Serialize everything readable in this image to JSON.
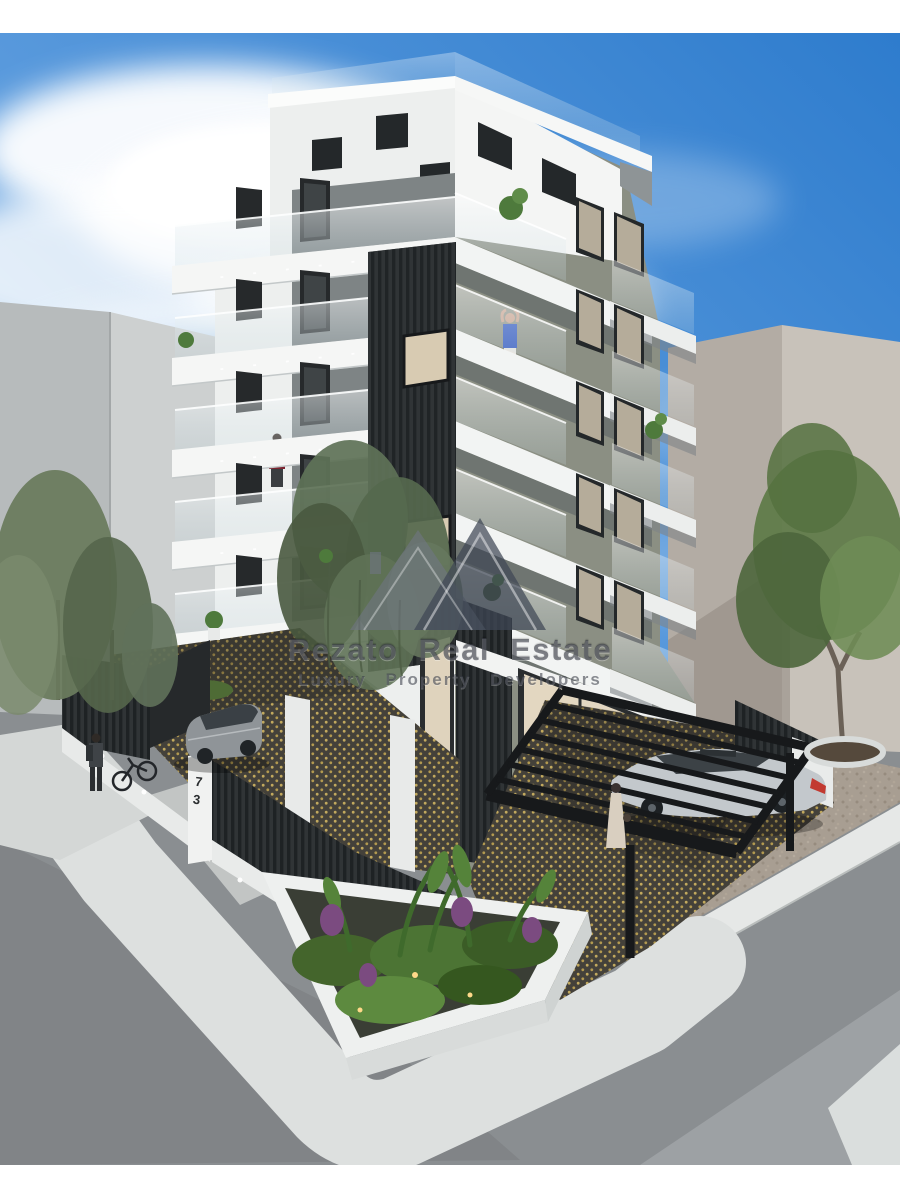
{
  "watermark": {
    "brand": "Rezato Real Estate",
    "tagline": "Luxury Property Developers",
    "logo_icon": "roof-peaks-icon"
  },
  "property": {
    "house_number": "73"
  },
  "palette": {
    "sky_top": "#2e7ccd",
    "sky_light": "#cfe3f5",
    "facade_white": "#f0f2f1",
    "facade_olive": "#8b8f83",
    "charcoal": "#2e3234",
    "glass_tint": "#dfe9ee",
    "street": "#8a8e91",
    "sidewalk": "#e6e8e7",
    "pebble": "#a89e92",
    "paving_dot_gold": "#c2a95e",
    "foliage": "#5c7548",
    "taillight_red": "#c23a31"
  }
}
